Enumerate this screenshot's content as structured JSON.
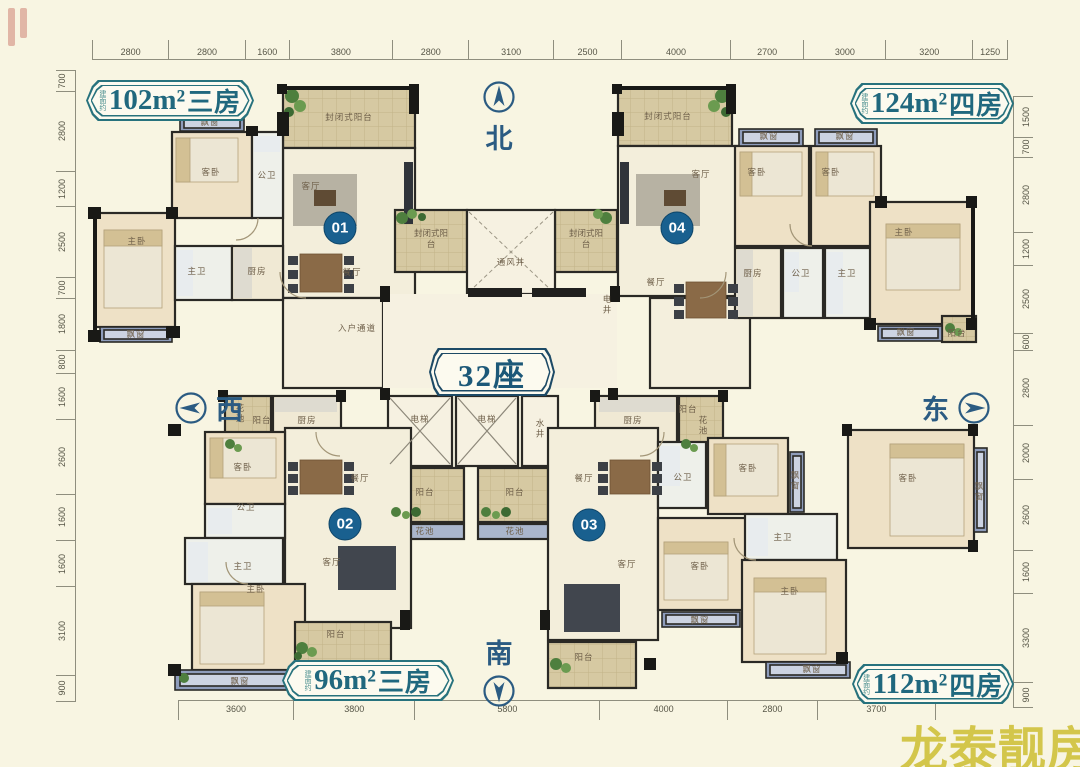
{
  "page": {
    "background": "#f8f5e2",
    "type": "residential-floor-plan"
  },
  "building": {
    "label": "32座"
  },
  "badges": {
    "top_left": {
      "prefix": "建面约",
      "area": "102m²",
      "rooms": "三房"
    },
    "top_right": {
      "prefix": "建面约",
      "area": "124m²",
      "rooms": "四房"
    },
    "bottom_left": {
      "prefix": "建面约",
      "area": "96m²",
      "rooms": "三房"
    },
    "bottom_right": {
      "prefix": "建面约",
      "area": "112m²",
      "rooms": "四房"
    }
  },
  "compass": {
    "north": "北",
    "south": "南",
    "west": "西",
    "east": "东"
  },
  "watermark": {
    "text": "龙泰靓房",
    "color": "#d3c64b"
  },
  "dimensions": {
    "top": [
      2800,
      2800,
      1600,
      3800,
      2800,
      3100,
      2500,
      4000,
      2700,
      3000,
      3200,
      1250
    ],
    "bottom": [
      3600,
      3800,
      5800,
      4000,
      2800,
      3700
    ],
    "left": [
      700,
      2800,
      1200,
      2500,
      700,
      1800,
      800,
      1600,
      2600,
      1600,
      1600,
      3100,
      900
    ],
    "right": [
      1500,
      700,
      2800,
      1200,
      2500,
      600,
      2800,
      2000,
      2600,
      1600,
      3300,
      900
    ]
  },
  "plan": {
    "units": [
      {
        "number": "01",
        "x": 340,
        "y": 228
      },
      {
        "number": "02",
        "x": 345,
        "y": 524
      },
      {
        "number": "03",
        "x": 589,
        "y": 525
      },
      {
        "number": "04",
        "x": 677,
        "y": 228
      }
    ],
    "room_labels": [
      {
        "t": "封闭式阳台",
        "x": 349,
        "y": 117
      },
      {
        "t": "客厅",
        "x": 311,
        "y": 186
      },
      {
        "t": "飘窗",
        "x": 210,
        "y": 122
      },
      {
        "t": "客卧",
        "x": 211,
        "y": 172
      },
      {
        "t": "公卫",
        "x": 267,
        "y": 175
      },
      {
        "t": "主卧",
        "x": 137,
        "y": 241
      },
      {
        "t": "主卫",
        "x": 197,
        "y": 271
      },
      {
        "t": "厨房",
        "x": 257,
        "y": 271
      },
      {
        "t": "餐厅",
        "x": 352,
        "y": 272
      },
      {
        "t": "飘窗",
        "x": 136,
        "y": 334
      },
      {
        "t": "入户通道",
        "x": 357,
        "y": 328
      },
      {
        "t": "封闭式阳台",
        "x": 431,
        "y": 239,
        "w": 38
      },
      {
        "t": "封闭式阳台",
        "x": 586,
        "y": 239,
        "w": 38
      },
      {
        "t": "通风井",
        "x": 511,
        "y": 262
      },
      {
        "t": "电井",
        "x": 607,
        "y": 305,
        "v": true
      },
      {
        "t": "封闭式阳台",
        "x": 668,
        "y": 116
      },
      {
        "t": "客厅",
        "x": 701,
        "y": 174
      },
      {
        "t": "飘窗",
        "x": 769,
        "y": 136
      },
      {
        "t": "飘窗",
        "x": 845,
        "y": 136
      },
      {
        "t": "客卧",
        "x": 757,
        "y": 172
      },
      {
        "t": "客卧",
        "x": 831,
        "y": 172
      },
      {
        "t": "餐厅",
        "x": 656,
        "y": 282
      },
      {
        "t": "厨房",
        "x": 753,
        "y": 273
      },
      {
        "t": "公卫",
        "x": 801,
        "y": 273
      },
      {
        "t": "主卫",
        "x": 847,
        "y": 273
      },
      {
        "t": "主卧",
        "x": 904,
        "y": 232
      },
      {
        "t": "飘窗",
        "x": 906,
        "y": 332
      },
      {
        "t": "阳台",
        "x": 957,
        "y": 333
      },
      {
        "t": "电梯",
        "x": 420,
        "y": 419
      },
      {
        "t": "电梯",
        "x": 487,
        "y": 419
      },
      {
        "t": "水井",
        "x": 540,
        "y": 429,
        "v": true
      },
      {
        "t": "阳台",
        "x": 425,
        "y": 492
      },
      {
        "t": "阳台",
        "x": 515,
        "y": 492
      },
      {
        "t": "花池",
        "x": 425,
        "y": 531
      },
      {
        "t": "花池",
        "x": 515,
        "y": 531
      },
      {
        "t": "花池",
        "x": 240,
        "y": 414,
        "v": true
      },
      {
        "t": "阳台",
        "x": 262,
        "y": 420
      },
      {
        "t": "厨房",
        "x": 307,
        "y": 420
      },
      {
        "t": "客卧",
        "x": 243,
        "y": 467
      },
      {
        "t": "餐厅",
        "x": 360,
        "y": 478
      },
      {
        "t": "公卫",
        "x": 246,
        "y": 507
      },
      {
        "t": "主卫",
        "x": 243,
        "y": 566
      },
      {
        "t": "客厅",
        "x": 332,
        "y": 562
      },
      {
        "t": "主卧",
        "x": 256,
        "y": 589
      },
      {
        "t": "阳台",
        "x": 336,
        "y": 634
      },
      {
        "t": "飘窗",
        "x": 240,
        "y": 681
      },
      {
        "t": "厨房",
        "x": 633,
        "y": 420
      },
      {
        "t": "阳台",
        "x": 688,
        "y": 409
      },
      {
        "t": "花池",
        "x": 703,
        "y": 426,
        "v": true
      },
      {
        "t": "餐厅",
        "x": 584,
        "y": 478
      },
      {
        "t": "客厅",
        "x": 627,
        "y": 564
      },
      {
        "t": "阳台",
        "x": 584,
        "y": 657
      },
      {
        "t": "公卫",
        "x": 683,
        "y": 477
      },
      {
        "t": "客卧",
        "x": 748,
        "y": 468
      },
      {
        "t": "飘窗",
        "x": 795,
        "y": 481,
        "v": true
      },
      {
        "t": "主卫",
        "x": 783,
        "y": 537
      },
      {
        "t": "客卧",
        "x": 700,
        "y": 566
      },
      {
        "t": "飘窗",
        "x": 700,
        "y": 620
      },
      {
        "t": "主卧",
        "x": 790,
        "y": 591
      },
      {
        "t": "飘窗",
        "x": 812,
        "y": 669
      },
      {
        "t": "客卧",
        "x": 908,
        "y": 478
      },
      {
        "t": "飘窗",
        "x": 979,
        "y": 492,
        "v": true
      }
    ],
    "colors": {
      "wall": "#1b1a18",
      "room": "#f3eedb",
      "bedroom": "#eee1c6",
      "balcony": "#d6c9a2",
      "bay_window": "#8e9cbb",
      "unit_marker": "#19608f",
      "accent_teal": "#27727d",
      "accent_navy": "#1d4a66"
    }
  }
}
